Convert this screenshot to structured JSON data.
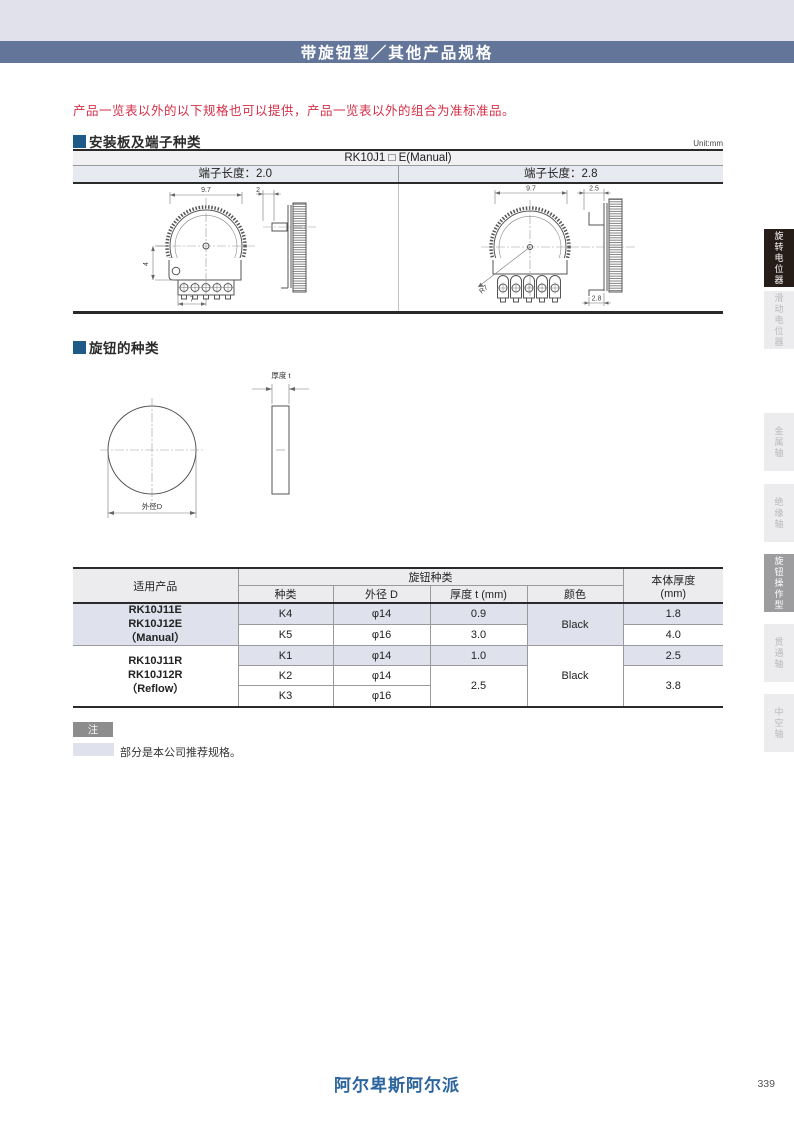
{
  "header": {
    "title": "带旋钮型／其他产品规格"
  },
  "notice": "产品一览表以外的以下规格也可以提供，产品一览表以外的组合为准标准品。",
  "sections": {
    "mounting": "安装板及端子种类",
    "knob": "旋钮的种类"
  },
  "mount_table": {
    "unit": "Unit:mm",
    "title": "RK10J1 □ E(Manual)",
    "col_left": "端子长度：2.0",
    "col_right": "端子长度：2.8"
  },
  "drawing_left": {
    "dim_top": "9.7",
    "dim_side": "2",
    "dim_left": "4",
    "dim_bottom": "7"
  },
  "drawing_right": {
    "dim_top": "9.7",
    "dim_side": "2.5",
    "dim_radius": "R7",
    "dim_bottom": "2.8"
  },
  "knob_drawing": {
    "diameter_label": "外径D",
    "thickness_label": "厚度 t"
  },
  "spec_table": {
    "headers": {
      "product": "适用产品",
      "knob_group": "旋钮种类",
      "kind": "种类",
      "dia": "外径 D",
      "thickness": "厚度 t (mm)",
      "color": "颜色",
      "body1": "本体厚度",
      "body2": "(mm)"
    },
    "group1": {
      "name1": "RK10J11E",
      "name2": "RK10J12E",
      "name3": "（Manual）",
      "color": "Black",
      "row1": {
        "kind": "K4",
        "dia": "φ14",
        "t": "0.9",
        "body": "1.8"
      },
      "row2": {
        "kind": "K5",
        "dia": "φ16",
        "t": "3.0",
        "body": "4.0"
      }
    },
    "group2": {
      "name1": "RK10J11R",
      "name2": "RK10J12R",
      "name3": "（Reflow）",
      "color": "Black",
      "row1": {
        "kind": "K1",
        "dia": "φ14",
        "t": "1.0",
        "body": "2.5"
      },
      "row2": {
        "kind": "K2",
        "dia": "φ14"
      },
      "row3": {
        "kind": "K3",
        "dia": "φ16"
      },
      "merged_t": "2.5",
      "merged_body": "3.8"
    }
  },
  "note": {
    "badge": "注",
    "text": "部分是本公司推荐规格。"
  },
  "footer": {
    "brand": "阿尔卑斯阿尔派",
    "page": "339"
  },
  "sidebar": {
    "tabs": [
      {
        "label": "旋转电位器"
      },
      {
        "label": "滑动电位器"
      },
      {
        "label": "金属轴"
      },
      {
        "label": "绝缘轴"
      },
      {
        "label": "旋钮操作型"
      },
      {
        "label": "贯通轴"
      },
      {
        "label": "中空轴"
      }
    ]
  },
  "colors": {
    "title_bar": "#63769a",
    "top_strip": "#e0e1ea",
    "section_marker": "#1e5a88",
    "highlight": "#dfe1ec",
    "brand_blue": "#2c649c",
    "notice_red": "#d63049",
    "tab_active_dark": "#261c18",
    "tab_active_gray": "#9d9da0"
  }
}
